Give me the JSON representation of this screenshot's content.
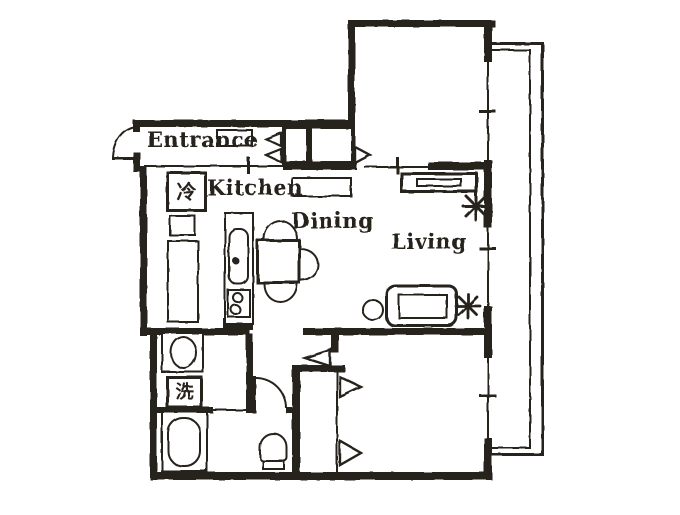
{
  "type": "floor-plan",
  "rooms": {
    "entrance": {
      "label": "Entrance"
    },
    "kitchen": {
      "label": "Kitchen"
    },
    "dining": {
      "label": "Dining"
    },
    "living": {
      "label": "Living"
    }
  },
  "appliances": {
    "refrigerator": {
      "label": "冷"
    },
    "washing_machine": {
      "label": "洗"
    }
  },
  "fixtures": [
    "kitchen-sink",
    "gas-stove",
    "kitchen-counter",
    "dining-table",
    "chair",
    "chair",
    "chair",
    "tv-board",
    "sofa",
    "side-table",
    "plant",
    "plant",
    "wash-basin",
    "bathtub",
    "toilet",
    "entrance-closet",
    "bedroom-closet",
    "balcony",
    "front-door",
    "interior-doors",
    "windows"
  ],
  "colors": {
    "ink": "#27201a",
    "paper": "#ffffff"
  }
}
